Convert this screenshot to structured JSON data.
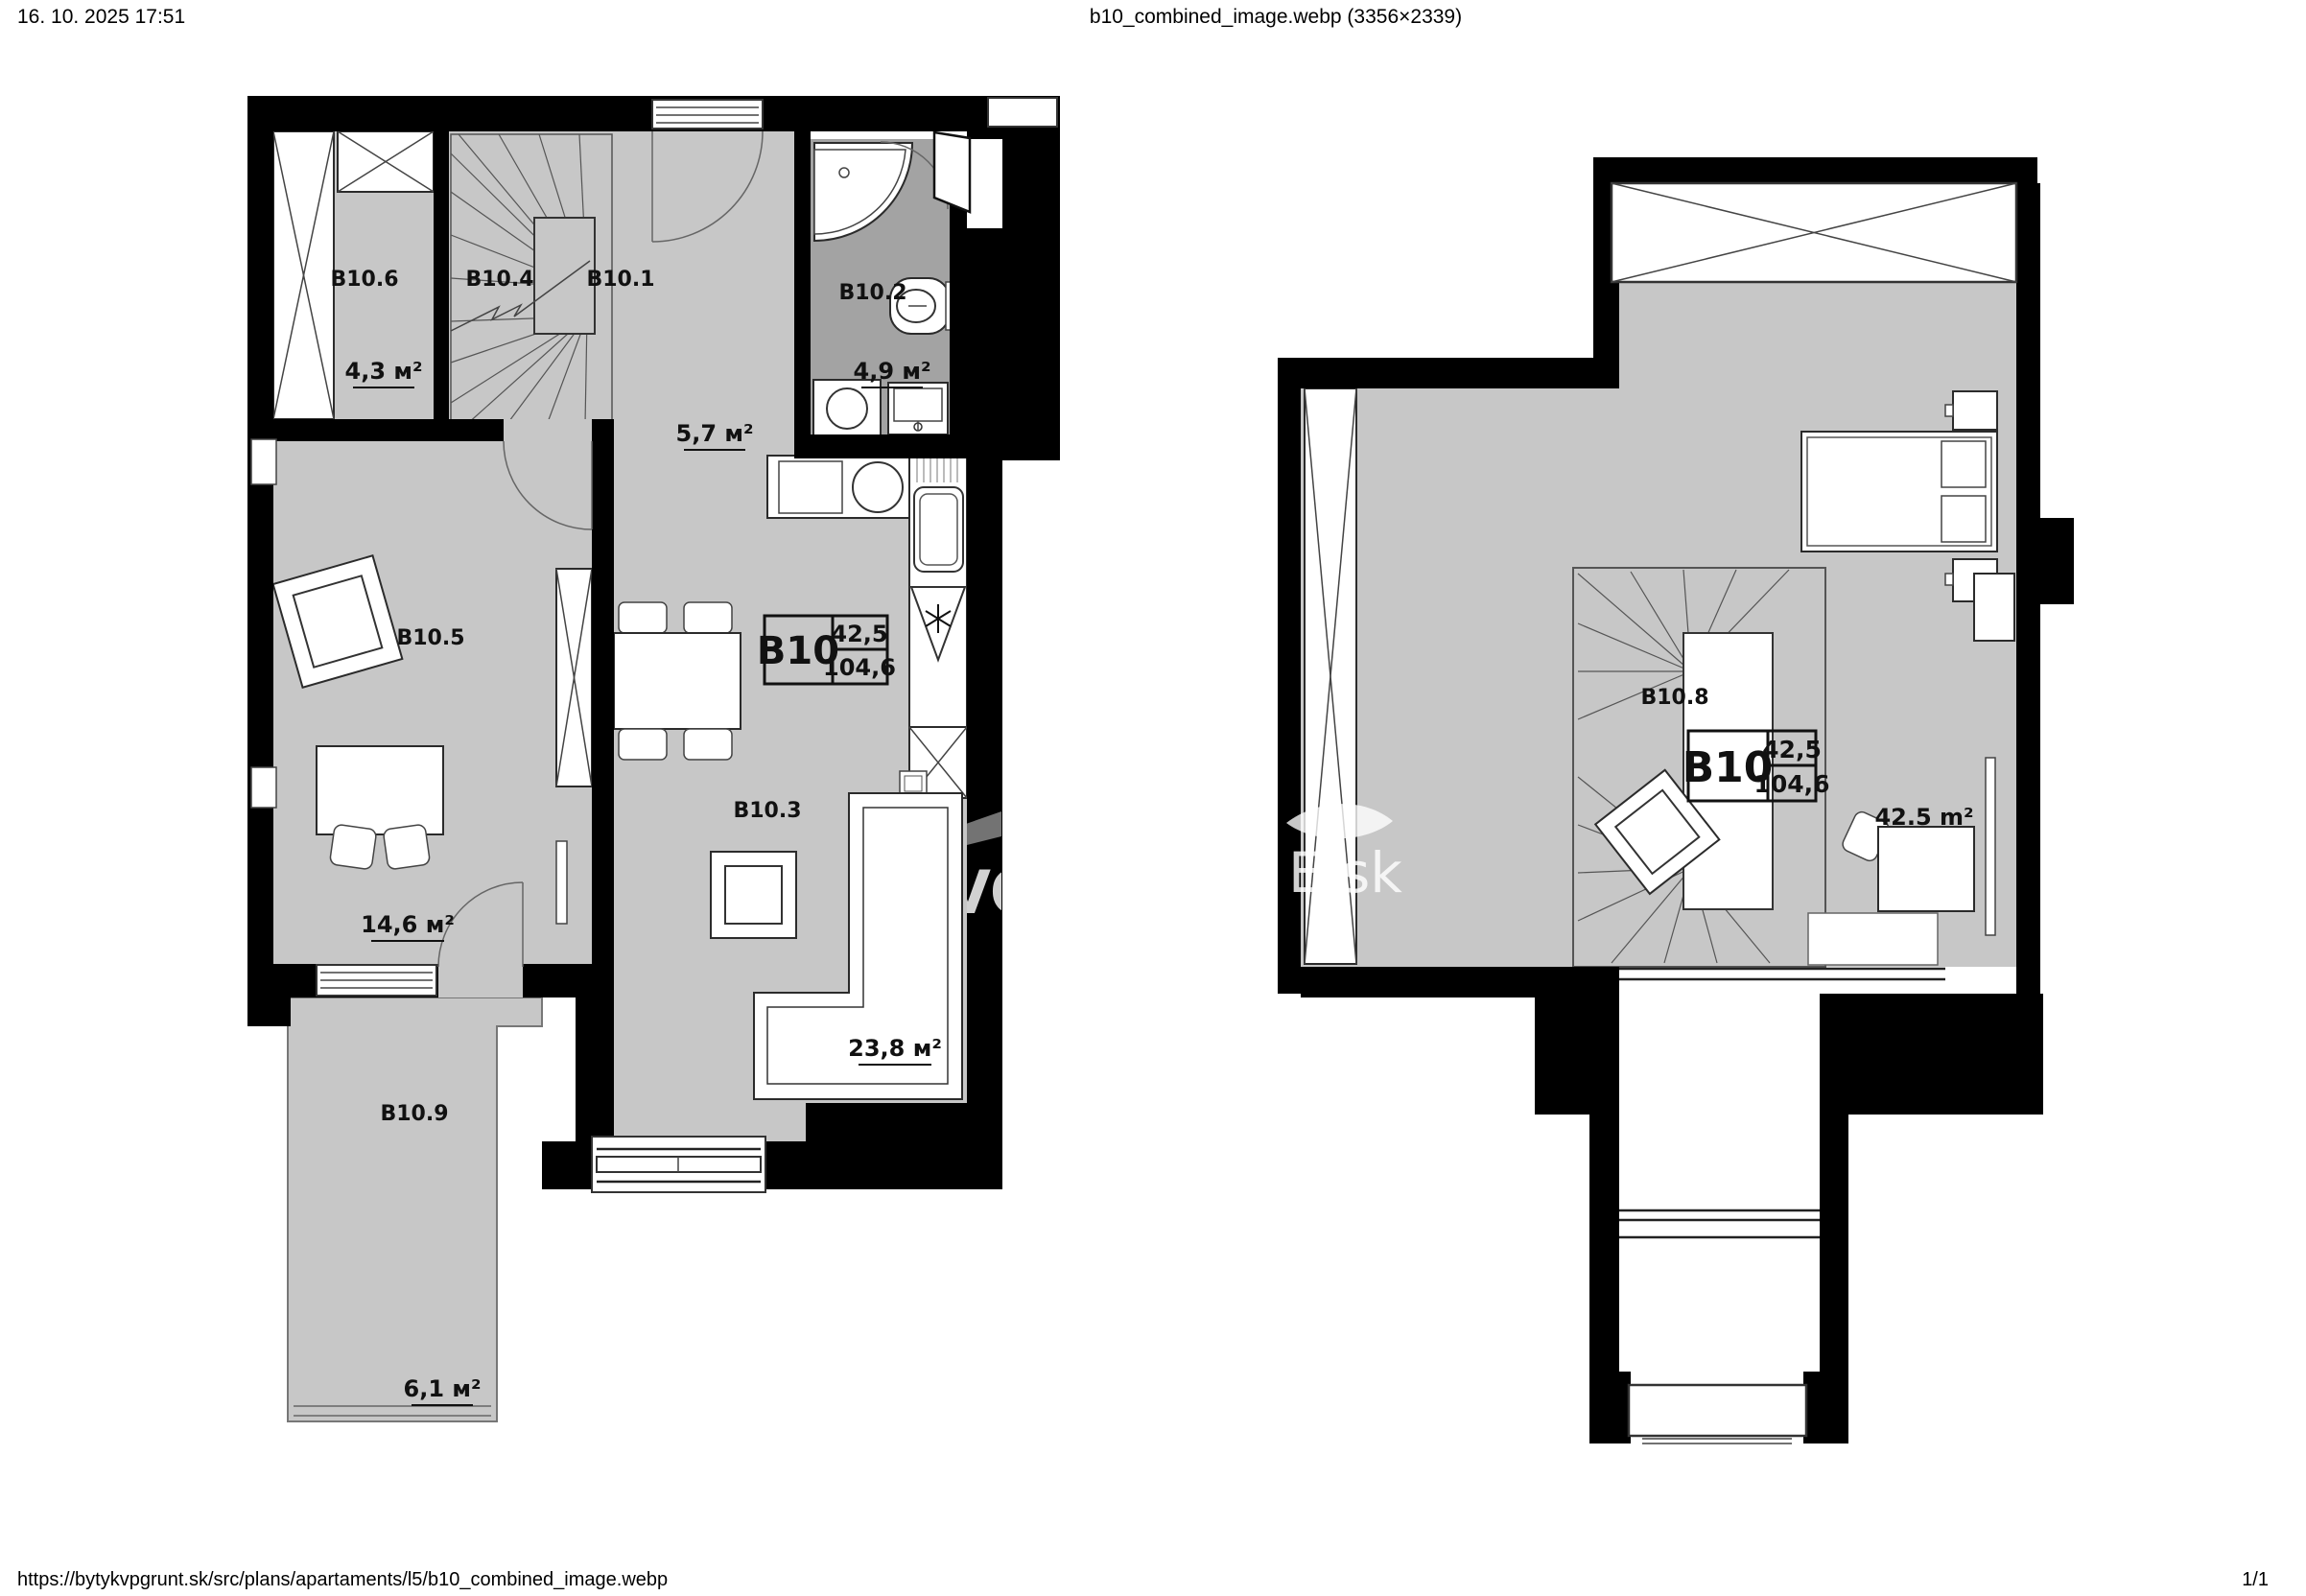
{
  "header": {
    "datetime": "16. 10. 2025 17:51",
    "title": "b10_combined_image.webp (3356×2339)"
  },
  "footer": {
    "url": "https://bytykvpgrunt.sk/src/plans/apartaments/l5/b10_combined_image.webp",
    "page_indicator": "1/1"
  },
  "unit": {
    "id": "B10",
    "floor_area": "42,5",
    "total_area": "104,6"
  },
  "ground_floor": {
    "rooms": [
      {
        "id": "B10.1",
        "area": "5,7 м²"
      },
      {
        "id": "B10.2",
        "area": "4,9 м²"
      },
      {
        "id": "B10.3",
        "area": "23,8 м²"
      },
      {
        "id": "B10.4",
        "area": ""
      },
      {
        "id": "B10.5",
        "area": "14,6 м²"
      },
      {
        "id": "B10.6",
        "area": "4,3 м²"
      },
      {
        "id": "B10.9",
        "area": "6,1 м²"
      }
    ]
  },
  "upper_floor": {
    "rooms": [
      {
        "id": "B10.8",
        "area": "42.5 m²"
      }
    ]
  },
  "watermark": {
    "fragment_left": "VO",
    "fragment_right": "E.sk"
  },
  "colors": {
    "floor": "#c7c7c7",
    "bathroom_floor": "#a3a3a3",
    "wall": "#000000"
  }
}
